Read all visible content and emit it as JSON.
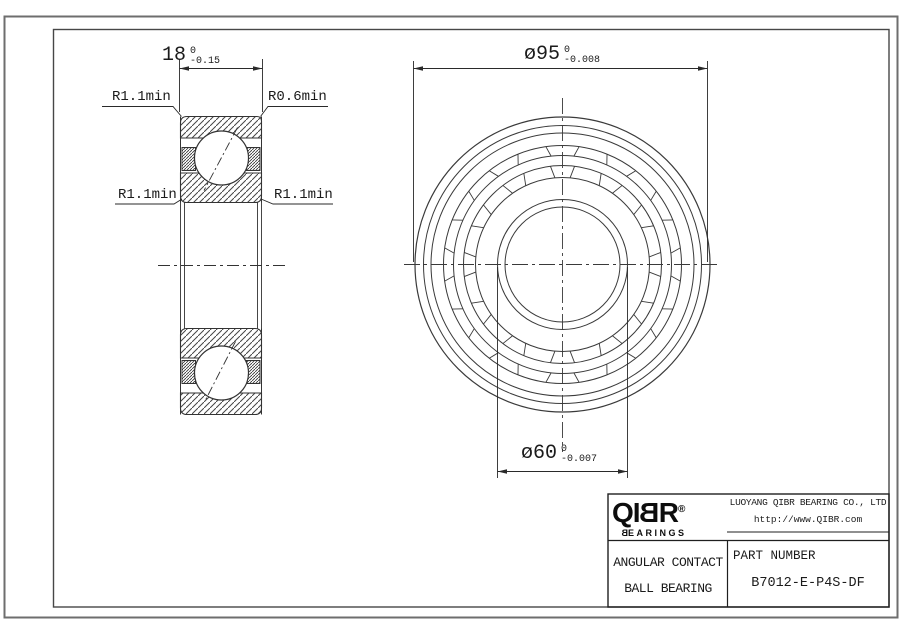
{
  "drawing": {
    "left_view": {
      "width_value": "18",
      "width_tol_upper": "0",
      "width_tol_lower": "-0.15",
      "label_top_left": "R1.1min",
      "label_top_right": "R0.6min",
      "label_mid_left": "R1.1min",
      "label_mid_right": "R1.1min"
    },
    "right_view": {
      "od_value": "ø95",
      "od_tol_upper": "0",
      "od_tol_lower": "-0.008",
      "bore_value": "ø60",
      "bore_tol_upper": "0",
      "bore_tol_lower": "-0.007"
    }
  },
  "title_block": {
    "logo_q": "Q",
    "logo_i": "I",
    "logo_b": "B",
    "logo_r": "R",
    "logo_reg": "®",
    "logo_sub_b": "B",
    "logo_sub_rest": "EARINGS",
    "company": "LUOYANG QIBR BEARING CO., LTD",
    "website": "http://www.QIBR.com",
    "product_line1": "ANGULAR CONTACT",
    "product_line2": "BALL BEARING",
    "part_number_label": "PART NUMBER",
    "part_number": "B7012-E-P4S-DF"
  },
  "colors": {
    "line": "#333333",
    "border_outer": "#6e6e6e",
    "border_inner": "#474747",
    "text": "#1b1b1b"
  }
}
